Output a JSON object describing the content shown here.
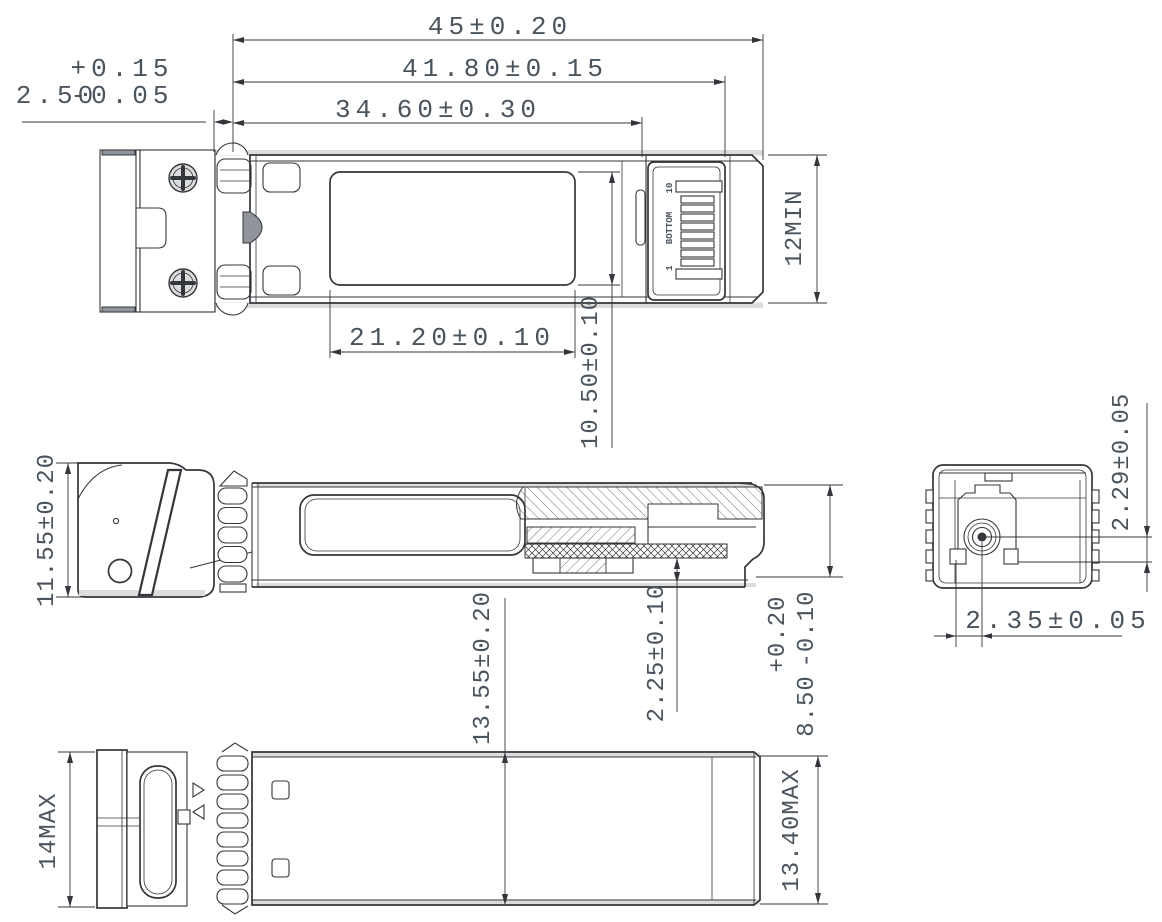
{
  "dims": {
    "overall_length": "45±0.20",
    "latch_length": "41.80±0.15",
    "housing_length": "34.60±0.30",
    "front_offset": "2.50",
    "front_offset_tol_upper": "+0.15",
    "front_offset_tol_lower": "-0.05",
    "label_area_length": "21.20±0.10",
    "label_area_width": "10.50±0.10",
    "card_edge": "12MIN",
    "front_height": "11.55±0.20",
    "module_width": "13.55±0.20",
    "pcb_offset": "2.25±0.10",
    "rear_height": "8.50",
    "rear_height_tol_upper": "+0.20",
    "rear_height_tol_lower": "-0.10",
    "fiber_axis_height": "2.29±0.05",
    "fiber_axis_offset": "2.35±0.05",
    "front_max": "14MAX",
    "rear_max": "13.40MAX"
  },
  "edge_connector": {
    "pad_last_label": "10",
    "pad_first_label": "1",
    "face_label": "BOTTOM"
  },
  "colors": {
    "background": "#ffffff",
    "line": "#33363a",
    "text": "#4b535c",
    "fill_light": "#dcdcdc",
    "fill_mid": "#8f959a"
  }
}
